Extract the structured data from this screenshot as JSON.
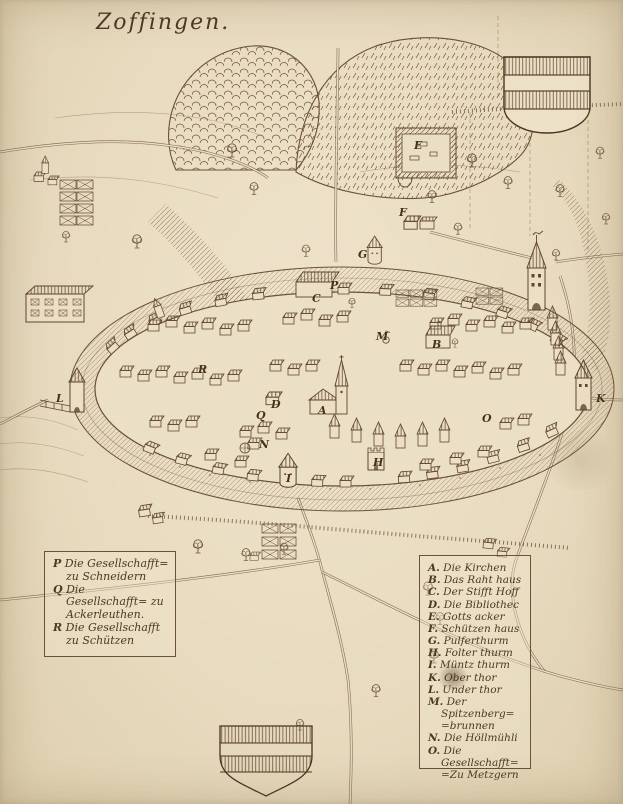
{
  "title": "Zoffingen.",
  "palette": {
    "parchment": "#e9dcc2",
    "ink": "#5e4631",
    "ink_dark": "#4a3522"
  },
  "legend_left": {
    "items": [
      {
        "key": "P",
        "label": "Die Gesellschafft= zu Schneidern"
      },
      {
        "key": "Q",
        "label": "Die Gesellschafft= zu Ackerleuthen."
      },
      {
        "key": "R",
        "label": "Die Gesellschafft zu Schützen"
      }
    ]
  },
  "legend_right": {
    "items": [
      {
        "key": "A.",
        "label": "Die Kirchen"
      },
      {
        "key": "B.",
        "label": "Das Raht haus"
      },
      {
        "key": "C.",
        "label": "Der Stifft Hoff"
      },
      {
        "key": "D.",
        "label": "Die Bibliothec"
      },
      {
        "key": "E.",
        "label": "Gotts acker"
      },
      {
        "key": "F.",
        "label": "Schützen haus"
      },
      {
        "key": "G.",
        "label": "Pulferthurm"
      },
      {
        "key": "H.",
        "label": "Folter thurm"
      },
      {
        "key": "I.",
        "label": "Müntz thurm"
      },
      {
        "key": "K.",
        "label": "Ober thor"
      },
      {
        "key": "L.",
        "label": "Under thor"
      },
      {
        "key": "M.",
        "label": "Der Spitzenberg= =brunnen"
      },
      {
        "key": "N.",
        "label": "Die Höllmühli"
      },
      {
        "key": "O.",
        "label": "Die Gesellschafft= =Zu Metzgern"
      }
    ]
  },
  "map_markers": [
    {
      "label": "A"
    },
    {
      "label": "B"
    },
    {
      "label": "C"
    },
    {
      "label": "D"
    },
    {
      "label": "E"
    },
    {
      "label": "F"
    },
    {
      "label": "G"
    },
    {
      "label": "H"
    },
    {
      "label": "I"
    },
    {
      "label": "K"
    },
    {
      "label": "L"
    },
    {
      "label": "M"
    },
    {
      "label": "N"
    },
    {
      "label": "O"
    },
    {
      "label": "P"
    },
    {
      "label": "Q"
    },
    {
      "label": "R"
    }
  ]
}
